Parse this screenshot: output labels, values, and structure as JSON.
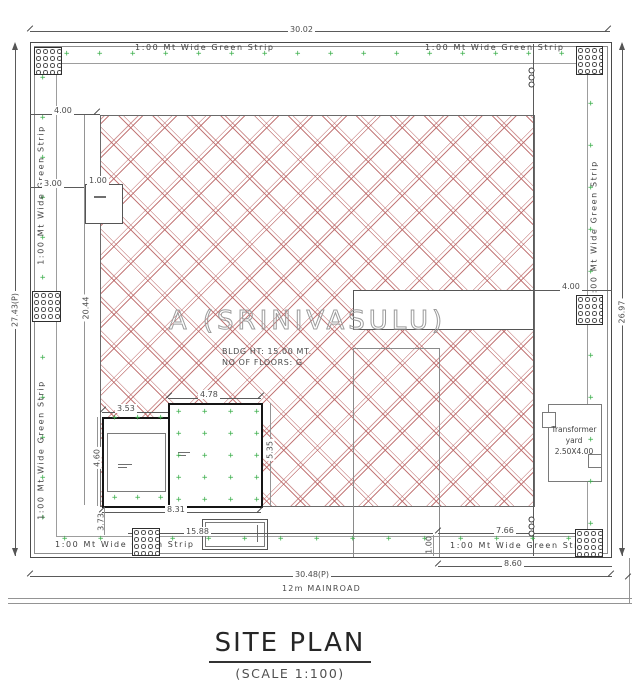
{
  "drawing": {
    "title": "SITE PLAN",
    "scale_note": "(SCALE 1:100)",
    "road_label": "12m  MAINROAD",
    "owner_label": "A  (SRINIVASULU)",
    "bldg_note_line1": "BLDG HT: 15.00 MT.",
    "bldg_note_line2": "NO OF FLOORS: G",
    "green_strip_label": "1:00 Mt Wide Green Strip",
    "transformer": {
      "line1": "Transformer",
      "line2": "yard",
      "line3": "2.50X4.00"
    }
  },
  "dimensions": {
    "top_width": "30.02",
    "bottom_width": "30.48(P)",
    "left_height": "27.43(P)",
    "right_height": "26.97",
    "setback_top": "4.00",
    "setback_right": "4.00",
    "gate_offset": "3.00",
    "gate_width": "1.00",
    "plot_depth": "20.44",
    "bldg_top_left": "3.53",
    "bldg_top_right": "4.78",
    "bldg_left": "4.60",
    "bldg_right": "5.35",
    "bldg_bottom": "8.31",
    "bldg_south_offset": "3.73",
    "yard_width": "15.88",
    "drive_width": "7.66",
    "strip_width": "1.00",
    "road_frontage": "8.60"
  },
  "colors": {
    "hatch_red": "#ba6464",
    "green": "#3aae4a",
    "line_gray": "#5a5a5a",
    "building_black": "#151515"
  },
  "decor": {
    "plus_symbol": "+",
    "plus_regions": [
      {
        "x": 64,
        "y": 50,
        "cols": 16,
        "rows": 1,
        "dx": 33,
        "dy": 0
      },
      {
        "x": 62,
        "y": 535,
        "cols": 15,
        "rows": 1,
        "dx": 36,
        "dy": 0
      },
      {
        "x": 40,
        "y": 74,
        "cols": 1,
        "rows": 12,
        "dx": 0,
        "dy": 40
      },
      {
        "x": 588,
        "y": 58,
        "cols": 1,
        "rows": 12,
        "dx": 0,
        "dy": 42
      },
      {
        "x": 176,
        "y": 408,
        "cols": 4,
        "rows": 5,
        "dx": 26,
        "dy": 22
      },
      {
        "x": 112,
        "y": 414,
        "cols": 3,
        "rows": 2,
        "dx": 23,
        "dy": 80
      }
    ]
  }
}
